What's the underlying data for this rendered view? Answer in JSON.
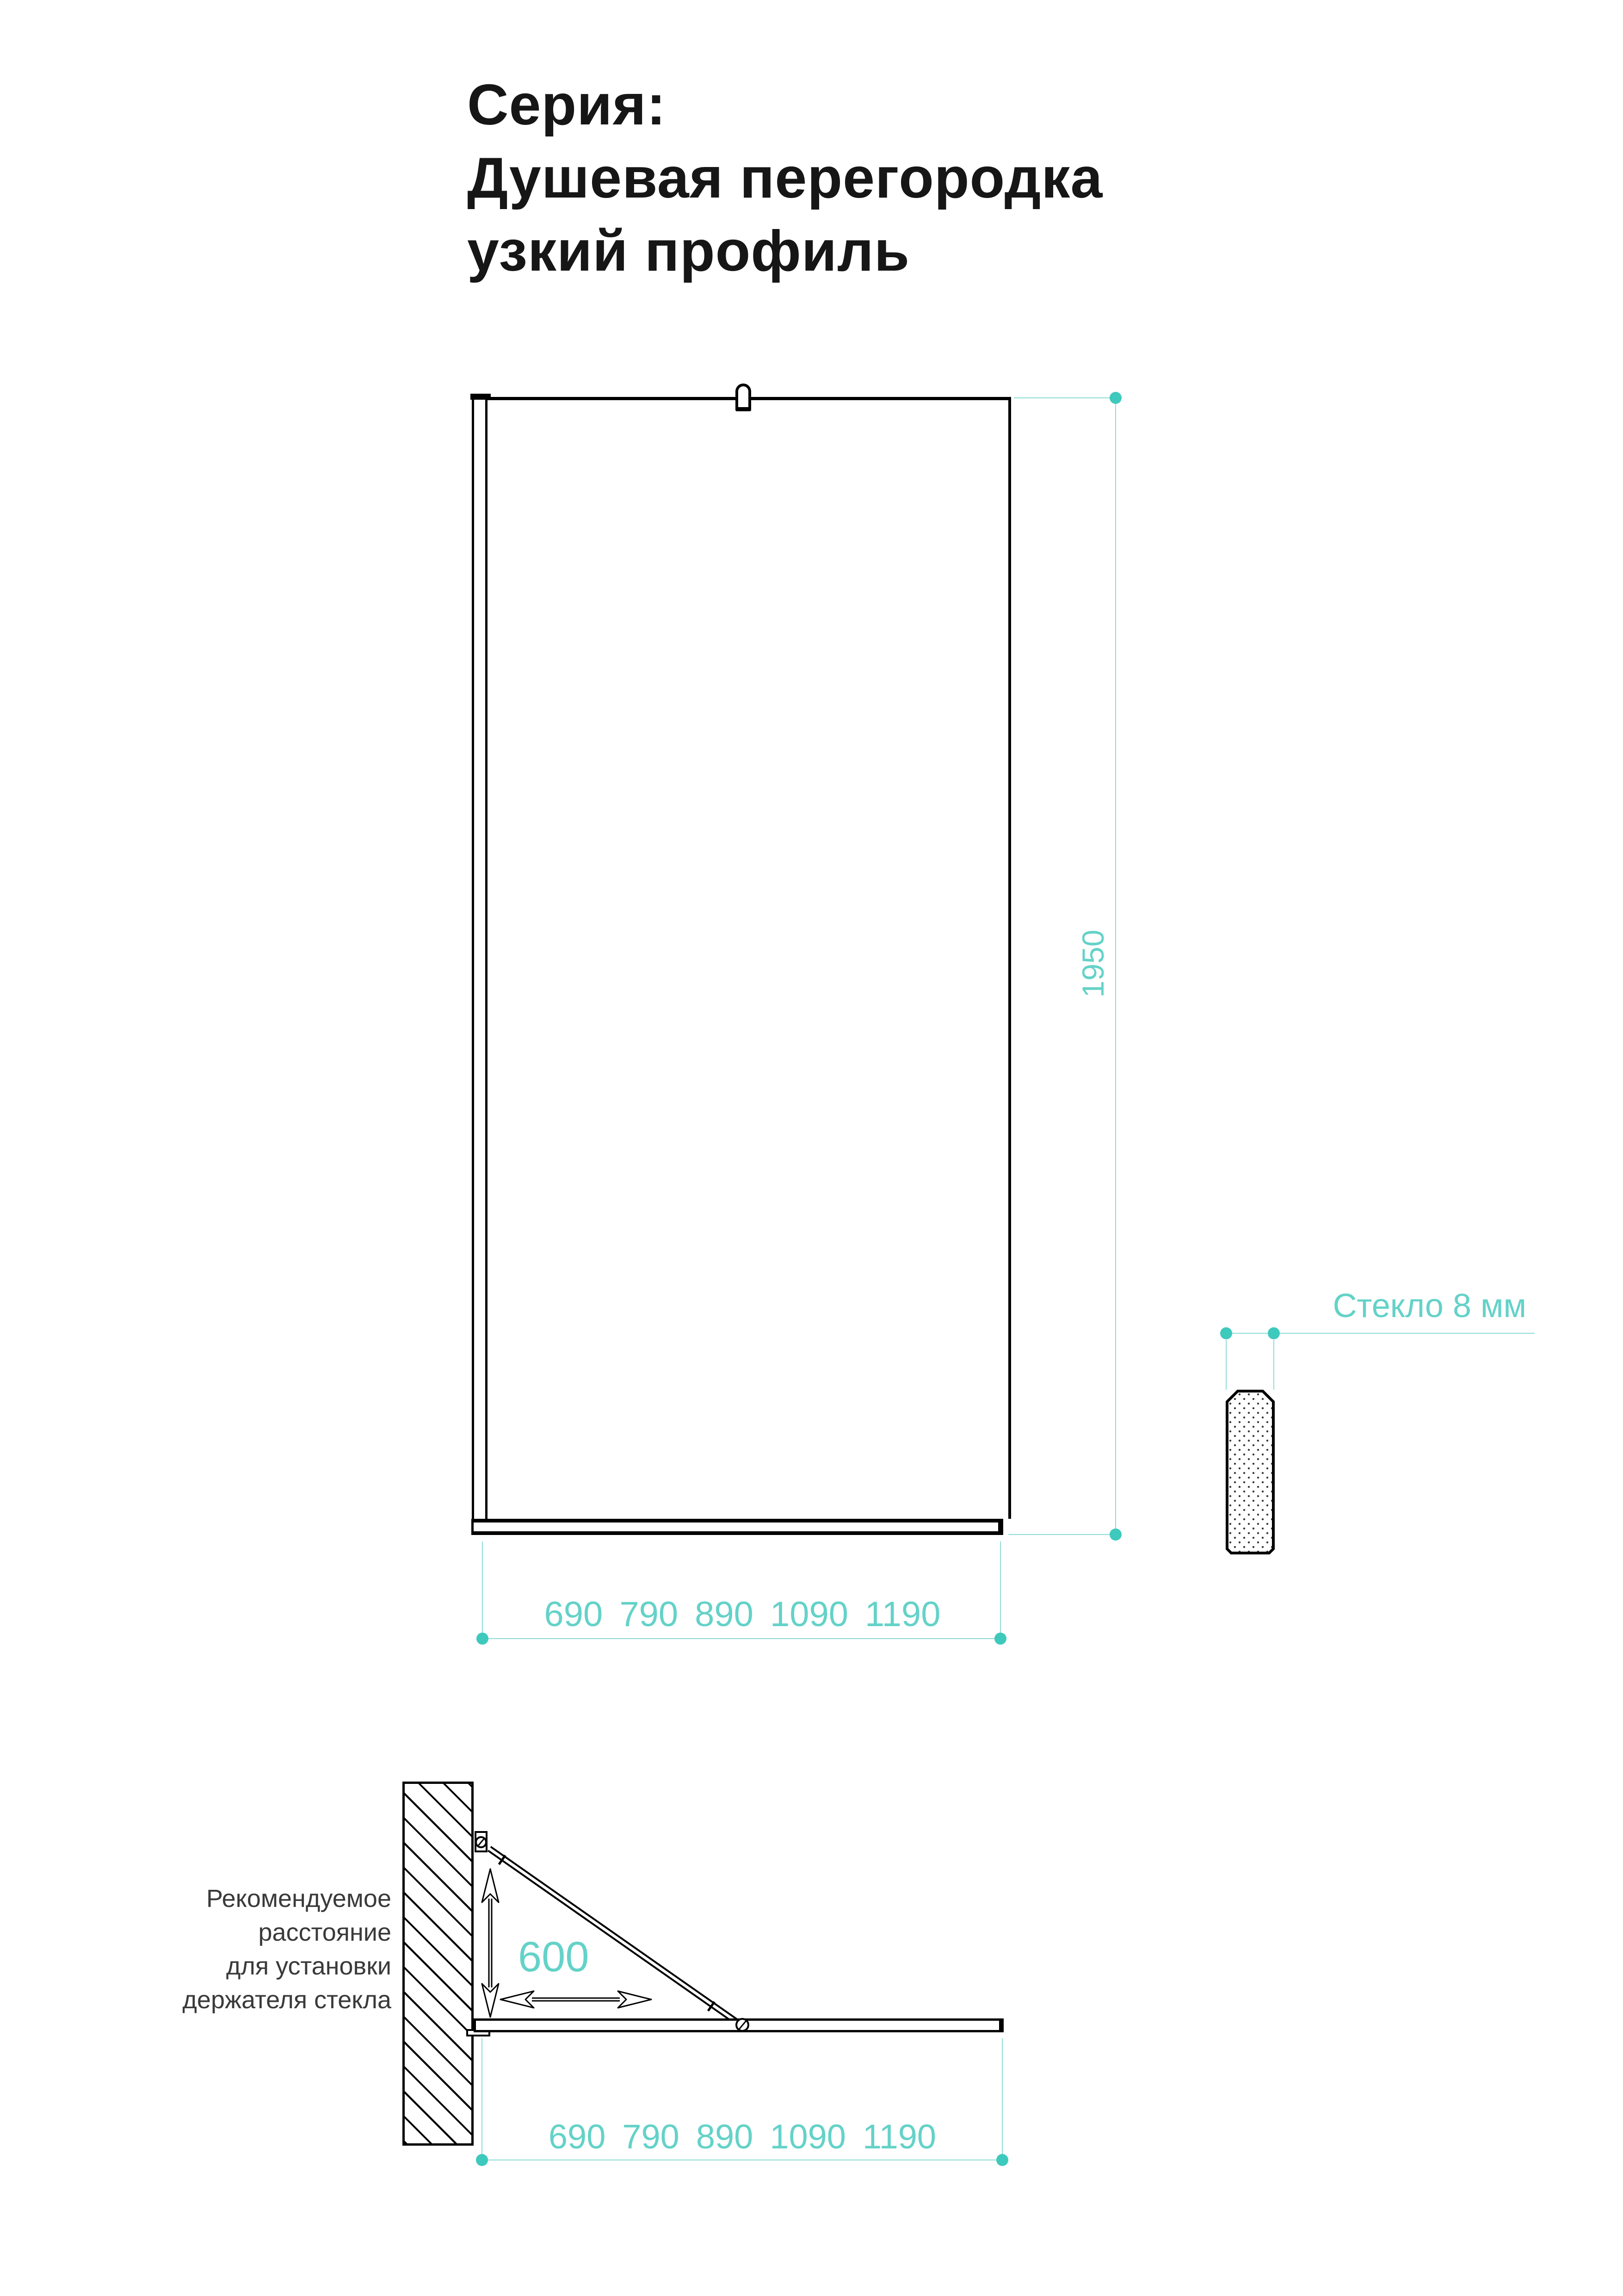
{
  "title": {
    "lines": [
      "Серия:",
      "Душевая перегородка",
      "узкий профиль"
    ]
  },
  "front_view": {
    "height_dimension": "1950",
    "width_options": [
      "690",
      "790",
      "890",
      "1090",
      "1190"
    ]
  },
  "glass_section": {
    "label": "Стекло 8 мм"
  },
  "side_view": {
    "holder_distance": "600",
    "width_options": [
      "690",
      "790",
      "890",
      "1090",
      "1190"
    ],
    "note_lines": [
      "Рекомендуемое",
      "расстояние",
      "для установки",
      "держателя стекла"
    ]
  },
  "colors": {
    "accent_text": "#64d2c8",
    "accent_line": "#8edcd5",
    "accent_dot": "#3ec9bd",
    "drawing_ink": "#000000",
    "title_ink": "#161616",
    "note_ink": "#3a3a3a"
  }
}
